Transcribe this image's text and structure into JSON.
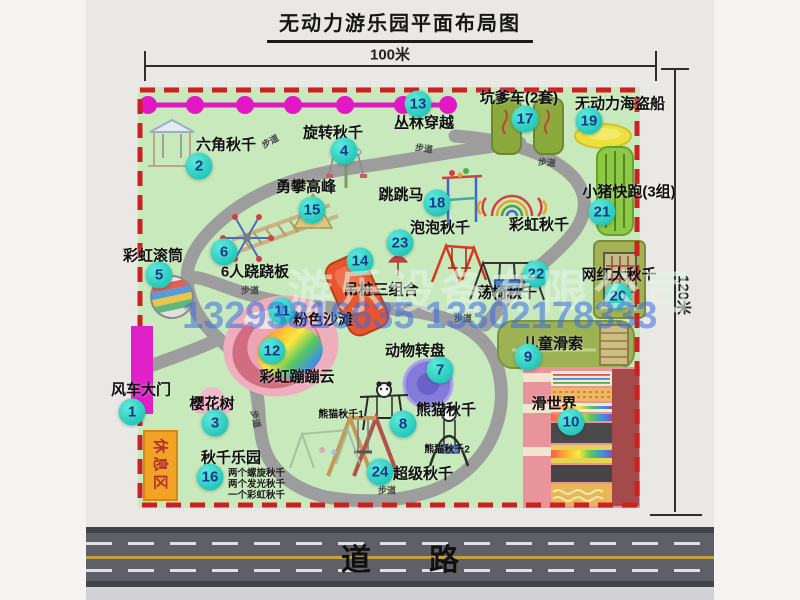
{
  "title": "无动力游乐园平面布局图",
  "dimensions": {
    "width": "100米",
    "height": "120米"
  },
  "road": {
    "label": "道路"
  },
  "watermark": {
    "company": "游乐设备有限公司",
    "phone": "13293816635 13302178333"
  },
  "rest_area": {
    "label": "休息区"
  },
  "path_label_text": "步道",
  "attractions": [
    {
      "num": "1",
      "name": "风车大门",
      "mx": 132,
      "my": 412,
      "lx": 141,
      "ly": 389
    },
    {
      "num": "2",
      "name": "六角秋千",
      "mx": 199,
      "my": 166,
      "lx": 226,
      "ly": 144
    },
    {
      "num": "3",
      "name": "樱花树",
      "mx": 215,
      "my": 423,
      "lx": 212,
      "ly": 403
    },
    {
      "num": "4",
      "name": "旋转秋千",
      "mx": 344,
      "my": 151,
      "lx": 333,
      "ly": 132
    },
    {
      "num": "5",
      "name": "彩虹滚筒",
      "mx": 159,
      "my": 275,
      "lx": 153,
      "ly": 255
    },
    {
      "num": "6",
      "name": "6人跷跷板",
      "mx": 224,
      "my": 252,
      "lx": 255,
      "ly": 271
    },
    {
      "num": "7",
      "name": "动物转盘",
      "mx": 440,
      "my": 370,
      "lx": 415,
      "ly": 350
    },
    {
      "num": "8",
      "name": "熊猫秋千",
      "mx": 403,
      "my": 424,
      "lx": 446,
      "ly": 409
    },
    {
      "num": "9",
      "name": "儿童滑索",
      "mx": 528,
      "my": 357,
      "lx": 553,
      "ly": 343
    },
    {
      "num": "10",
      "name": "滑世界",
      "mx": 571,
      "my": 422,
      "lx": 554,
      "ly": 403
    },
    {
      "num": "11",
      "name": "粉色沙滩",
      "mx": 282,
      "my": 311,
      "lx": 323,
      "ly": 319
    },
    {
      "num": "12",
      "name": "彩虹蹦蹦云",
      "mx": 272,
      "my": 351,
      "lx": 297,
      "ly": 376
    },
    {
      "num": "13",
      "name": "丛林穿越",
      "mx": 418,
      "my": 104,
      "lx": 424,
      "ly": 122
    },
    {
      "num": "14",
      "name": "吊桩三组合",
      "mx": 360,
      "my": 261,
      "lx": 381,
      "ly": 289
    },
    {
      "num": "15",
      "name": "勇攀高峰",
      "mx": 312,
      "my": 210,
      "lx": 306,
      "ly": 186
    },
    {
      "num": "16",
      "name": "秋千乐园",
      "mx": 210,
      "my": 477,
      "lx": 231,
      "ly": 457
    },
    {
      "num": "17",
      "name": "坑爹车(2套)",
      "mx": 525,
      "my": 119,
      "lx": 519,
      "ly": 97
    },
    {
      "num": "18",
      "name": "跳跳马",
      "mx": 437,
      "my": 203,
      "lx": 401,
      "ly": 194
    },
    {
      "num": "19",
      "name": "无动力海盗船",
      "mx": 589,
      "my": 121,
      "lx": 620,
      "ly": 103
    },
    {
      "num": "20",
      "name": "网红大秋千",
      "mx": 618,
      "my": 296,
      "lx": 619,
      "ly": 274
    },
    {
      "num": "21",
      "name": "小猪快跑(3组)",
      "mx": 602,
      "my": 212,
      "lx": 629,
      "ly": 191
    },
    {
      "num": "22",
      "name": "荡椅秋千",
      "mx": 536,
      "my": 274,
      "lx": 507,
      "ly": 292
    },
    {
      "num": "23",
      "name": "泡泡秋千",
      "mx": 400,
      "my": 243,
      "lx": 440,
      "ly": 227
    },
    {
      "num": "24",
      "name": "超级秋千",
      "mx": 380,
      "my": 472,
      "lx": 423,
      "ly": 473
    }
  ],
  "extra_labels": [
    {
      "text": "彩虹秋千",
      "x": 539,
      "y": 224,
      "size": 15
    },
    {
      "text": "熊猫秋千1",
      "x": 341,
      "y": 413,
      "size": 10
    },
    {
      "text": "熊猫秋千2",
      "x": 447,
      "y": 448,
      "size": 10
    }
  ],
  "swing_park_details": {
    "x": 228,
    "y": 468,
    "lines": [
      "两个螺旋秋千",
      "两个发光秋千",
      "一个彩虹秋千"
    ]
  },
  "path_labels": [
    {
      "x": 270,
      "y": 141,
      "r": -28
    },
    {
      "x": 424,
      "y": 148,
      "r": 8
    },
    {
      "x": 547,
      "y": 162,
      "r": 5
    },
    {
      "x": 250,
      "y": 290,
      "r": 0
    },
    {
      "x": 463,
      "y": 318,
      "r": 0
    },
    {
      "x": 256,
      "y": 419,
      "r": 78
    },
    {
      "x": 387,
      "y": 490,
      "r": 0
    }
  ]
}
